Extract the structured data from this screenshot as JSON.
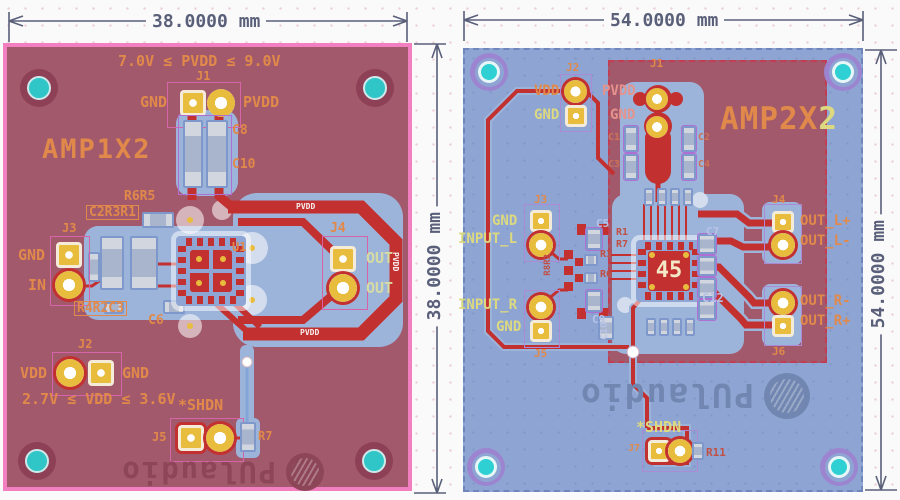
{
  "dims": {
    "left_w": "38.0000 mm",
    "left_h": "38.0000 mm",
    "right_w": "54.0000 mm",
    "right_h": "54.0000 mm"
  },
  "left": {
    "title": "AMP1X2",
    "pvdd_note": "7.0V ≤ PVDD ≤ 9.0V",
    "vdd_note": "2.7V ≤ VDD ≤ 3.6V",
    "shdn": "*SHDN",
    "logo": "PUlaudio",
    "j1": "J1",
    "j1_gnd": "GND",
    "j1_pvdd": "PVDD",
    "c8": "C8",
    "c10": "C10",
    "r6r5": "R6R5",
    "c2r3r1": "C2R3R1",
    "j3": "J3",
    "j3_gnd": "GND",
    "j3_in": "IN",
    "r4r2c3": "R4R2C3",
    "u1": "U1",
    "c6": "C6",
    "j4": "J4",
    "out_a": "OUT",
    "out_b": "OUT",
    "j2": "J2",
    "j2_vdd": "VDD",
    "j2_gnd": "GND",
    "j5": "J5",
    "r7": "R7",
    "pvdd_trace_top": "PVDD",
    "pvdd_trace_right": "PVDD",
    "pvdd_trace_bottom": "PVDD"
  },
  "right": {
    "title_main": "AMP2X",
    "title_tail": "2",
    "logo": "PUlaudio",
    "chip": "45",
    "shdn": "*SHDN",
    "j1": "J1",
    "j1_pvdd": "PVDD",
    "j1_gnd": "GND",
    "j2": "J2",
    "j2_vdd": "VDD",
    "j2_gnd": "GND",
    "c1": "C1",
    "c2": "C2",
    "c3": "C3",
    "c4": "C4",
    "j3": "J3",
    "j3_gnd": "GND",
    "input_l": "INPUT_L",
    "j5": "J5",
    "j5_gnd": "GND",
    "input_r": "INPUT_R",
    "r8r2": "R8R2",
    "c5": "C5",
    "r3": "R3",
    "r6": "R6",
    "c9": "C9",
    "r1": "R1",
    "r7": "R7",
    "c7": "C7",
    "c10": "C10",
    "c12": "C12",
    "j4": "J4",
    "out_lp": "OUT_L+",
    "out_lm": "OUT_L-",
    "j6": "J6",
    "out_rm": "OUT_R-",
    "out_rp": "OUT_R+",
    "j7": "J7",
    "r11": "R11"
  }
}
